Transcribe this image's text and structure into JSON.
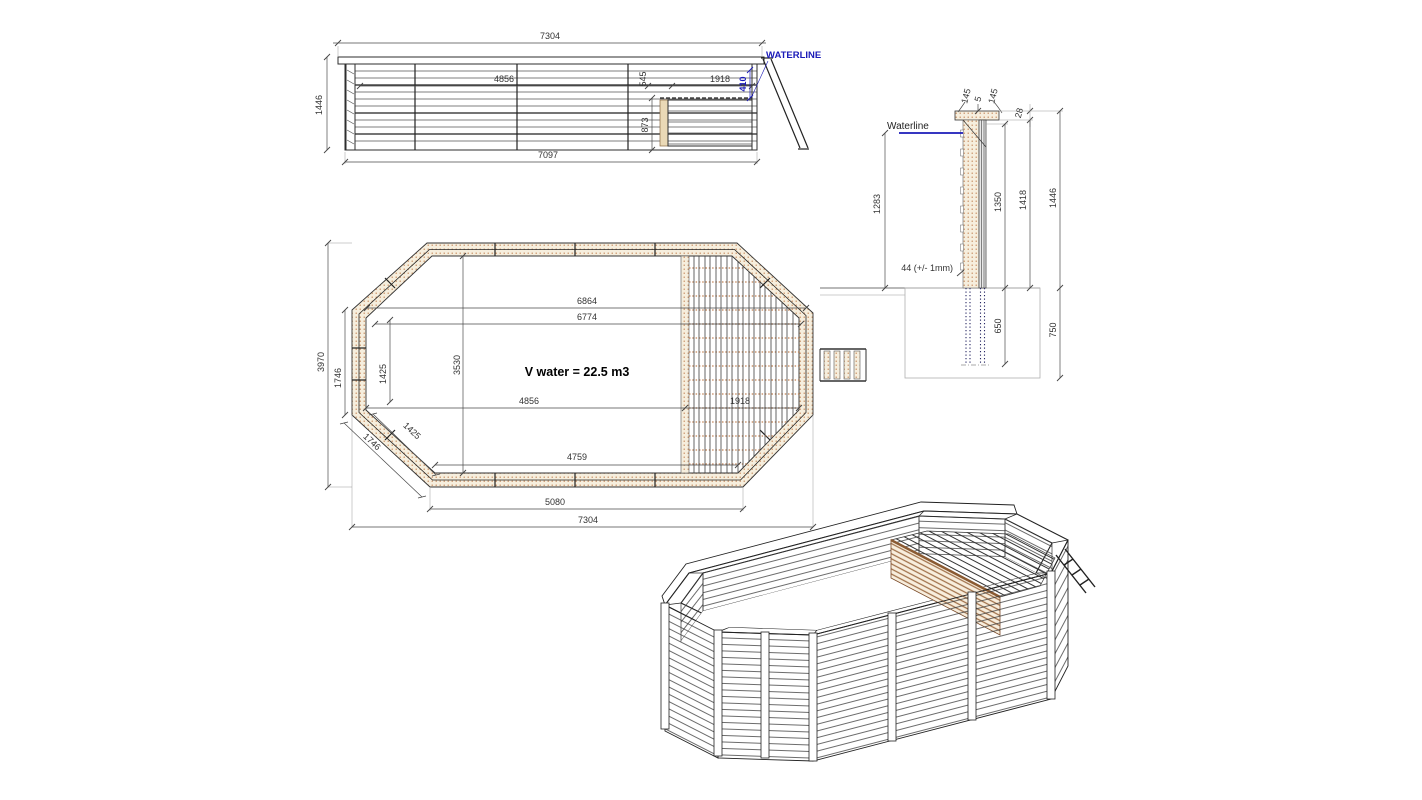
{
  "colors": {
    "line": "#2e2e2e",
    "dimension": "#4a4a4a",
    "waterline_blue": "#1a1ab8",
    "wood_dot_tan": "#c4875a",
    "wood_cream": "#f6eedd",
    "wood_brown": "#8a5a32",
    "excavation_gray": "#b0b0b0"
  },
  "elevation": {
    "waterline_label": "WATERLINE",
    "dims": {
      "overall_width_top": "7304",
      "overall_height": "1446",
      "base_width": "7097",
      "floor_length": "4856",
      "gap": "545",
      "deck_length": "1918",
      "water_offset": "410",
      "under_deck_height": "873"
    }
  },
  "plan": {
    "volume_label": "V water = 22.5 m3",
    "dims": {
      "inner_width_top": "6864",
      "inner_width": "6774",
      "inner_height": "3530",
      "side_panel_vertical": "1425",
      "side_panel_diagonal": "1425",
      "left_side_vertical": "1746",
      "left_side_diagonal": "1746",
      "overall_height": "3970",
      "floor_length": "4856",
      "deck_length": "1918",
      "inner_bottom": "4759",
      "bottom_edge": "5080",
      "overall_width": "7304"
    }
  },
  "section": {
    "waterline_label": "Waterline",
    "dims": {
      "cap_front": "145",
      "cap_gap": "5",
      "cap_back": "145",
      "cap_height": "28",
      "water_depth": "1283",
      "wall_inner": "1350",
      "wall_outer": "1418",
      "wall_total": "1446",
      "plank_thickness": "44 (+/- 1mm)",
      "post_embed": "650",
      "pit_depth": "750"
    }
  }
}
